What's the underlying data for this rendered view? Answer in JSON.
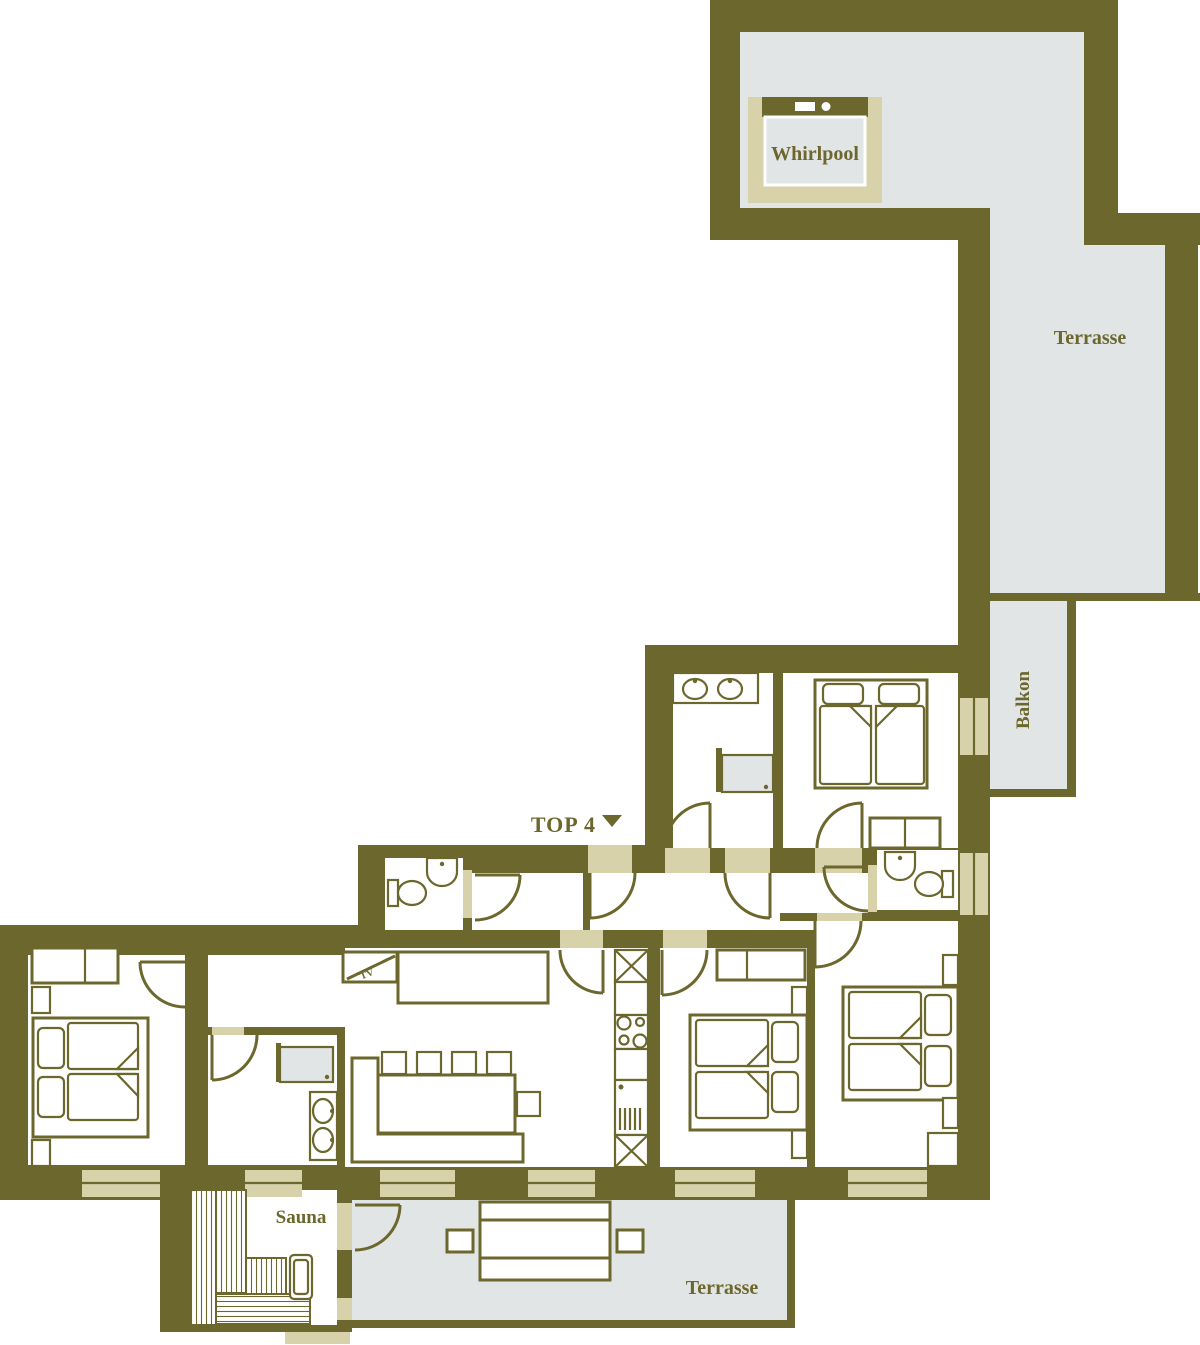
{
  "plan": {
    "unit_label": "TOP 4",
    "labels": {
      "whirlpool": "Whirlpool",
      "terrace_upper": "Terrasse",
      "balcony": "Balkon",
      "sauna": "Sauna",
      "terrace_lower": "Terrasse",
      "tv": "TV"
    },
    "colors": {
      "wall": "#6c672c",
      "outdoor_floor": "#e2e5e6",
      "opening": "#d8d2aa",
      "interior": "#ffffff"
    }
  }
}
